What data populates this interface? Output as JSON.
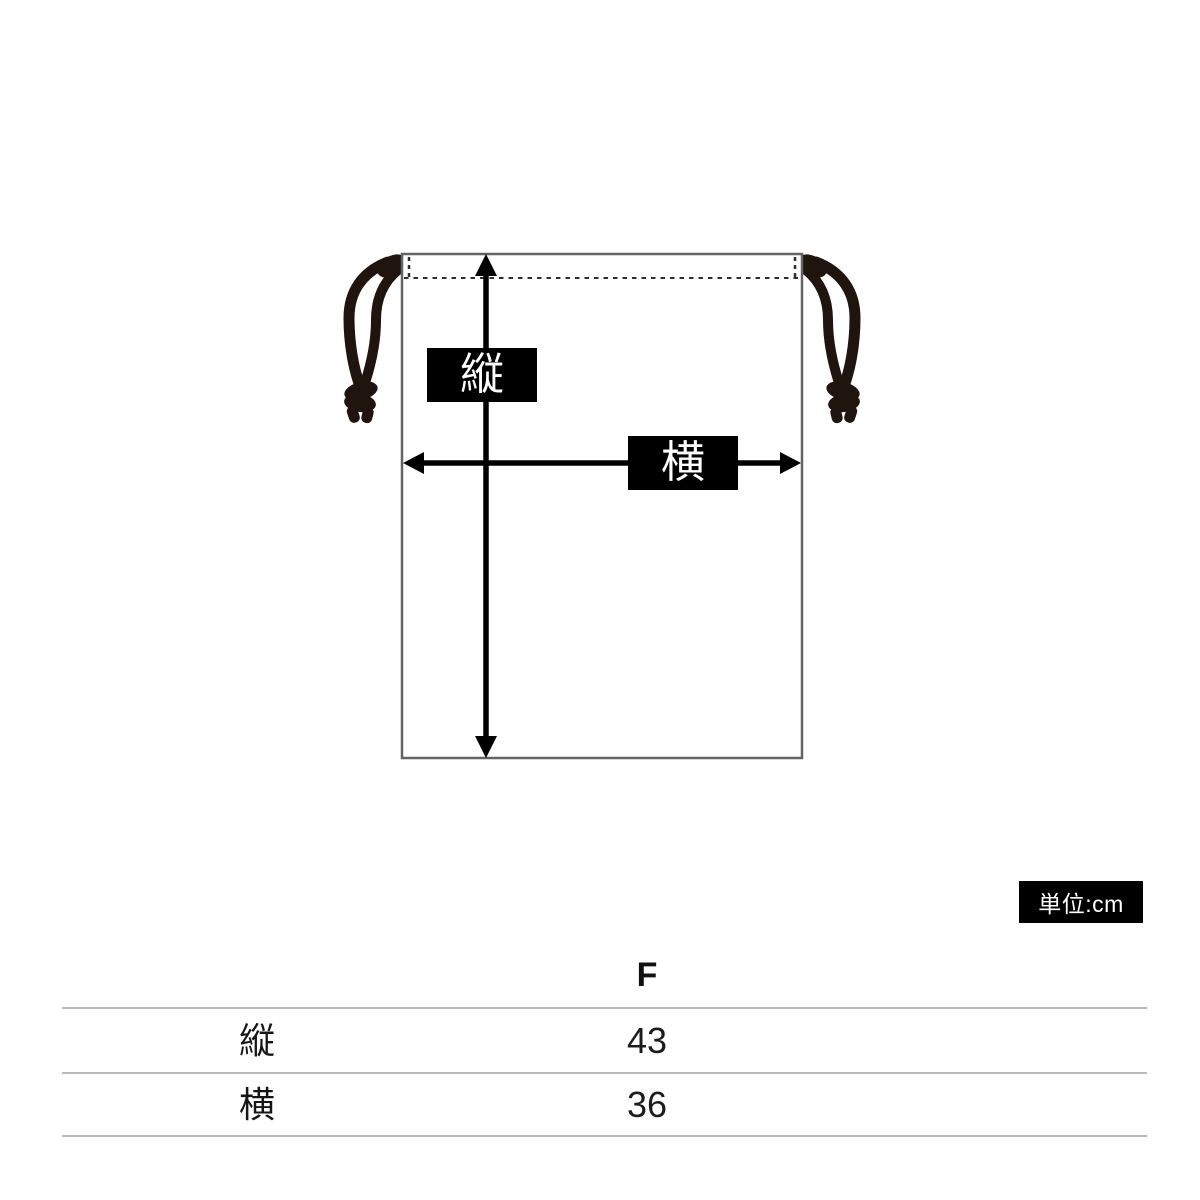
{
  "diagram": {
    "item": "drawstring-bag",
    "height_label": "縦",
    "width_label": "横",
    "colors": {
      "bag_outline": "#636363",
      "stitch_dashed": "#2e2e2e",
      "cord": "#20150e",
      "arrow": "#000000",
      "label_bg": "#000000",
      "label_text": "#ffffff"
    }
  },
  "unit_badge": {
    "text": "単位:cm",
    "bg": "#000000",
    "color": "#ffffff"
  },
  "size_table": {
    "size_header": "F",
    "rows": [
      {
        "label": "縦",
        "value": "43"
      },
      {
        "label": "横",
        "value": "36"
      }
    ]
  }
}
